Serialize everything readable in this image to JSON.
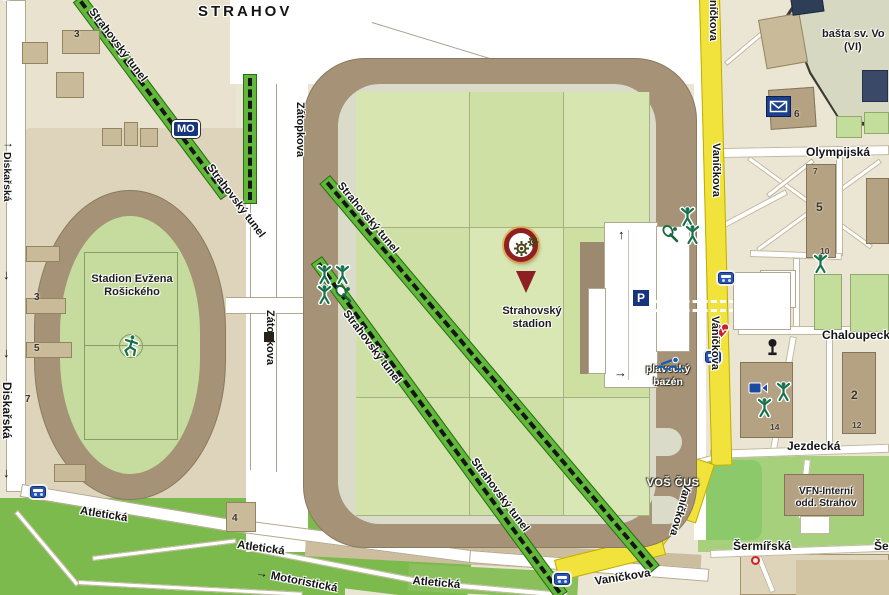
{
  "colors": {
    "road_yellow": "#f2e33c",
    "tunnel_green": "#61b83a",
    "stadium_brown": "#a69276",
    "infield_green": "#d2e2aa",
    "park_green": "#7cba4e",
    "marker_red": "#8c2022",
    "sign_blue": "#16357d"
  },
  "district": {
    "label": "STRAHOV"
  },
  "streets": {
    "diskarska": "Diskařská",
    "zatopkova": "Zátopkova",
    "atleticka": "Atletická",
    "motoristicka": "Motoristická",
    "vanickova": "Vaníčkova",
    "olympijska": "Olympijská",
    "chaloupeckeho": "Chaloupecke",
    "jezdecka": "Jezdecká",
    "sermirska": "Šermířská",
    "tunnel": "Strahovský tunel"
  },
  "places": {
    "rosicky_line1": "Stadion Evžena",
    "rosicky_line2": "Rošického",
    "strahov_line1": "Strahovský",
    "strahov_line2": "stadion",
    "basta_line1": "bašta sv. Vo",
    "basta_line2": "(VI)",
    "vfn_line1": "VFN-Interní",
    "vfn_line2": "odd. Strahov",
    "vos_cus": "VOŠ ČUS",
    "bazen_line1": "plavecký",
    "bazen_line2": "bazén"
  },
  "signs": {
    "metro": "MO",
    "parking": "P"
  },
  "arrows": {
    "up": "↑",
    "right": "→",
    "down": "↓"
  },
  "numbers": {
    "n3_topleft": "3",
    "n3_west": "3",
    "n5_west": "5",
    "n7_west": "7",
    "n4_corner": "4",
    "n5_east": "5",
    "n6": "6",
    "n7_east": "7",
    "n10": "10",
    "n2": "2",
    "n12": "12",
    "n14": "14"
  }
}
